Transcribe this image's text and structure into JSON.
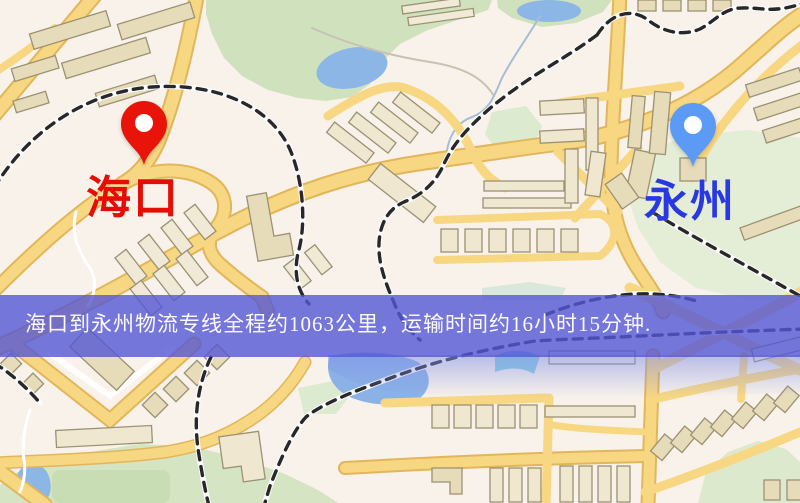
{
  "map": {
    "origin_label": "海口",
    "destination_label": "永州"
  },
  "banner": {
    "text": "海口到永州物流专线全程约1063公里，运输时间约16小时15分钟."
  },
  "icons": {
    "origin_pin": "red-map-pin",
    "destination_pin": "blue-map-pin"
  },
  "colors": {
    "banner_bg": "#5456d5",
    "banner_text": "#fbfaff",
    "origin_pin": "#e81309",
    "origin_label": "#e60d04",
    "destination_pin": "#5b9bf6",
    "destination_label": "#2838e2",
    "road": "#f8d782",
    "road_casing": "#e2b65a",
    "building": "#e7dcba",
    "park": "#d5e4c2",
    "water": "#8cb6e6",
    "railway": "#28282a",
    "map_background": "#f8f2ea"
  }
}
